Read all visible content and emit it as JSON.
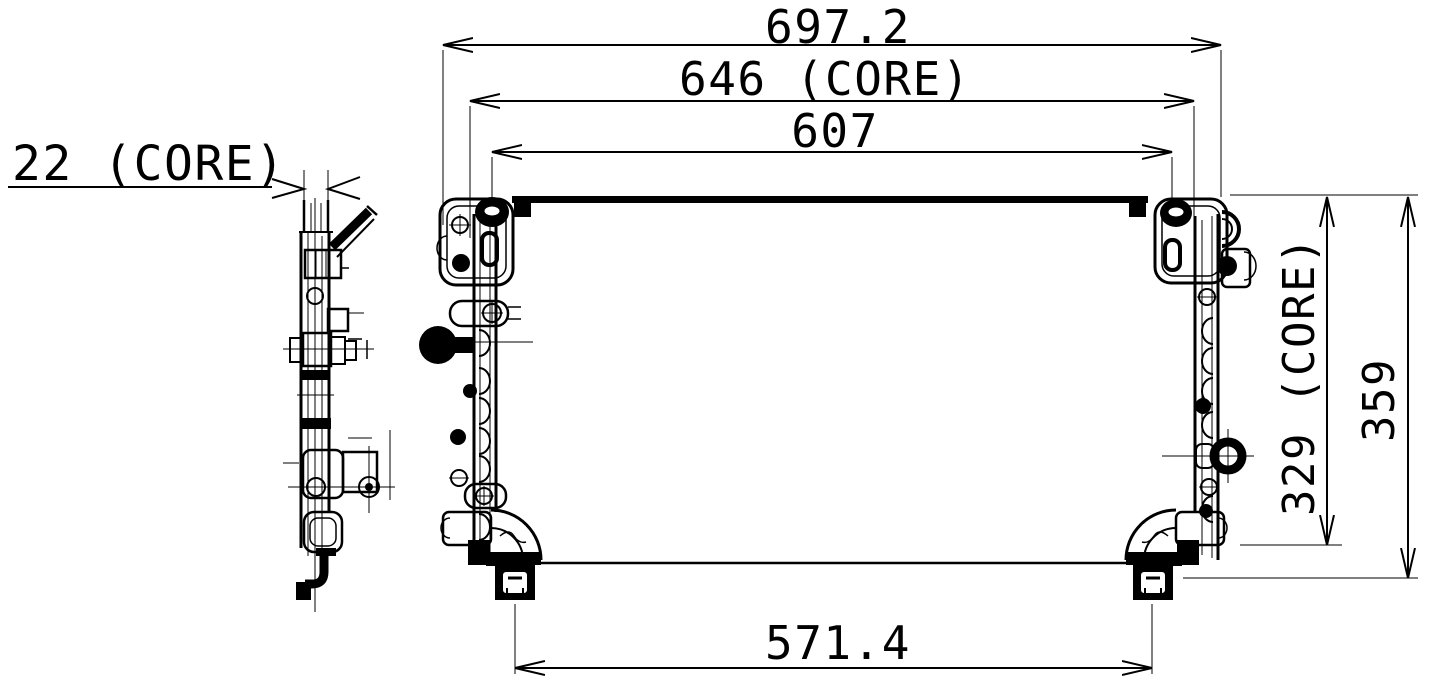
{
  "page": {
    "background_color": "#ffffff",
    "line_color": "#000000"
  },
  "drawing": {
    "dimensions": {
      "overall_width": "697.2",
      "core_width": "646 (CORE)",
      "tank_width": "607",
      "mount_span": "571.4",
      "side_depth": "22 (CORE)",
      "core_height": "329 (CORE)",
      "overall_height": "359"
    }
  }
}
